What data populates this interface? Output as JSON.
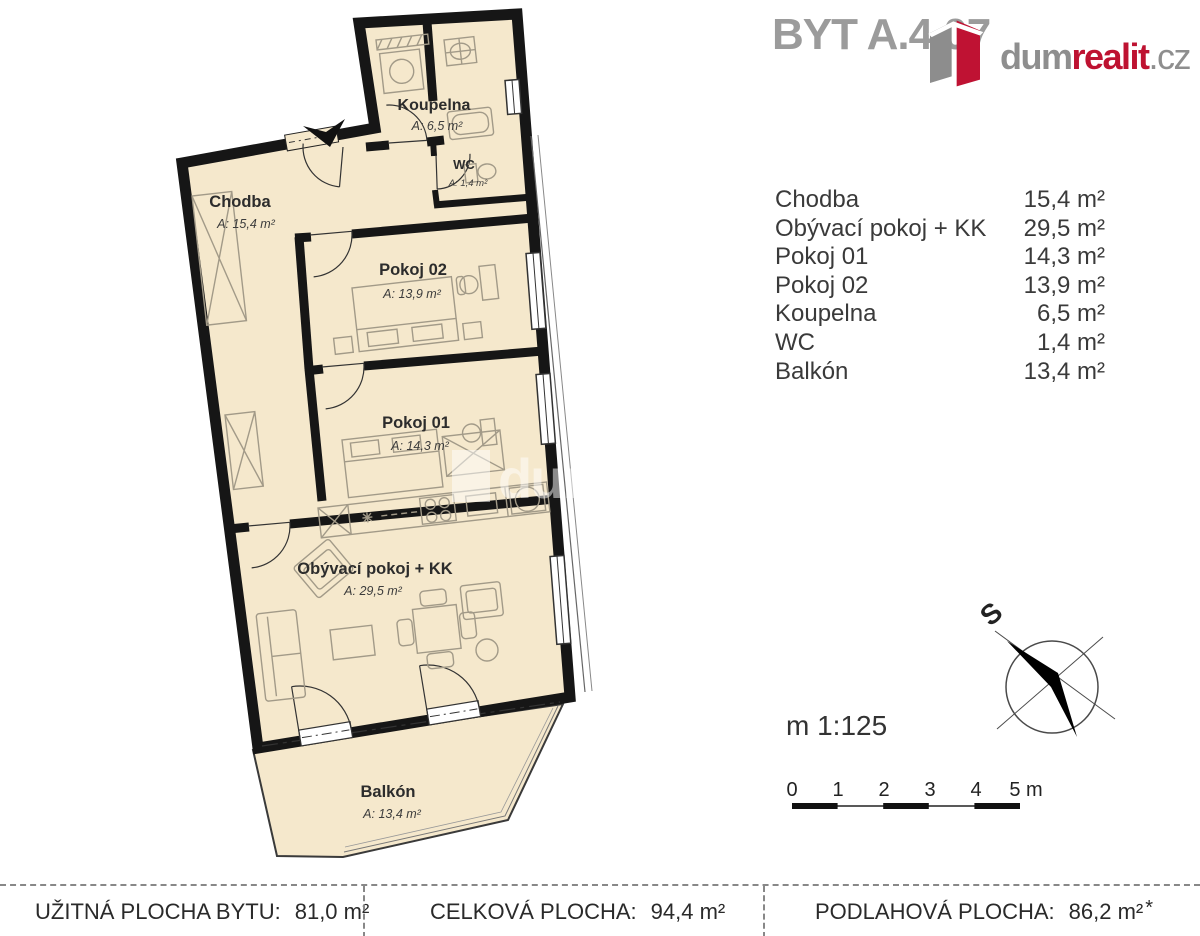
{
  "header": {
    "title": "BYT A.4.07",
    "logo": {
      "gray1": "dum",
      "red": "realit",
      "gray2": ".cz"
    }
  },
  "legend": {
    "rooms": [
      {
        "name": "Chodba",
        "area": "15,4 m²"
      },
      {
        "name": "Obývací pokoj + KK",
        "area": "29,5 m²"
      },
      {
        "name": "Pokoj 01",
        "area": "14,3 m²"
      },
      {
        "name": "Pokoj 02",
        "area": "13,9 m²"
      },
      {
        "name": "Koupelna",
        "area": "6,5 m²"
      },
      {
        "name": "WC",
        "area": "1,4 m²"
      },
      {
        "name": "Balkón",
        "area": "13,4 m²"
      }
    ]
  },
  "plan": {
    "rooms": [
      {
        "name": "Koupelna",
        "area": "A: 6,5 m²"
      },
      {
        "name": "WC",
        "area": "A: 1,4 m²"
      },
      {
        "name": "Chodba",
        "area": "A: 15,4 m²"
      },
      {
        "name": "Pokoj 02",
        "area": "A: 13,9 m²"
      },
      {
        "name": "Pokoj 01",
        "area": "A: 14,3 m²"
      },
      {
        "name": "Obývací pokoj + KK",
        "area": "A: 29,5 m²"
      },
      {
        "name": "Balkón",
        "area": "A: 13,4 m²"
      }
    ],
    "watermark": "dumrealit.cz"
  },
  "compass": {
    "label": "S"
  },
  "scale": {
    "text": "m 1:125",
    "ticks": [
      "0",
      "1",
      "2",
      "3",
      "4",
      "5 m"
    ]
  },
  "totals": {
    "items": [
      {
        "label": "UŽITNÁ PLOCHA BYTU:",
        "value": "81,0 m²",
        "note": ""
      },
      {
        "label": "CELKOVÁ PLOCHA:",
        "value": "94,4 m²",
        "note": ""
      },
      {
        "label": "PODLAHOVÁ PLOCHA:",
        "value": "86,2 m²",
        "note": "*"
      }
    ]
  },
  "colors": {
    "room_fill": "#f5e8cc",
    "wall": "#161616",
    "accent_red": "#be1231",
    "title_gray": "#9b9b9b",
    "furniture": "#a29a88"
  }
}
